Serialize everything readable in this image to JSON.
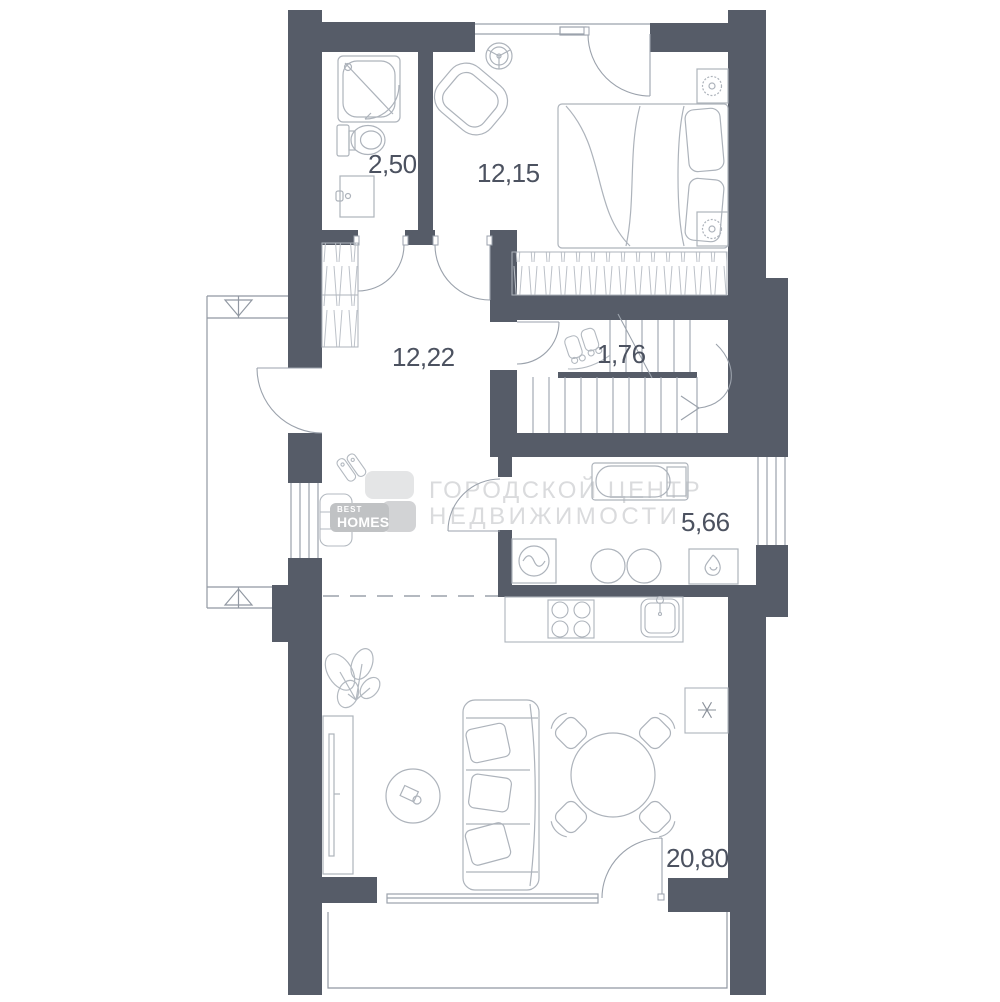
{
  "document": {
    "type": "floor-plan"
  },
  "rooms": [
    {
      "id": "bathroom",
      "area_label": "2,50"
    },
    {
      "id": "bedroom",
      "area_label": "12,15"
    },
    {
      "id": "hall",
      "area_label": "12,22"
    },
    {
      "id": "stair-landing",
      "area_label": "1,76"
    },
    {
      "id": "utility-bathroom",
      "area_label": "5,66"
    },
    {
      "id": "living-kitchen",
      "area_label": "20,80"
    }
  ],
  "watermark": {
    "line1": "ГОРОДСКОЙ ЦЕНТР",
    "line2": "НЕДВИЖИМОСТИ"
  },
  "logo": {
    "line1": "BEST",
    "line2": "HOMES"
  },
  "colors": {
    "wall": "#565C68",
    "architecture_line": "#9BA2AC",
    "furniture_line": "#ADB3BB",
    "hatch_line": "#BCC1C8",
    "label_text": "#4C5260",
    "watermark_text": "#DADBDD",
    "logo_tile": "#C0C2C4",
    "background": "#FFFFFF"
  }
}
